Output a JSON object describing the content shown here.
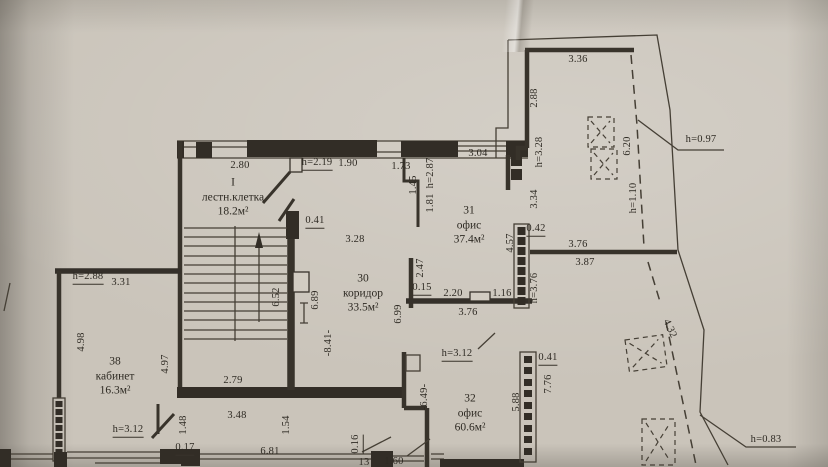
{
  "document": {
    "kind": "floor-plan photograph",
    "language": "ru"
  },
  "colors": {
    "paper": "#cac4ba",
    "ink": "#38332b"
  },
  "rooms": [
    {
      "number": "I",
      "name": "лестн.клетка",
      "area": "18.2м²",
      "x": 233,
      "y": 197
    },
    {
      "number": "30",
      "name": "коридор",
      "area": "33.5м²",
      "x": 363,
      "y": 293
    },
    {
      "number": "31",
      "name": "офис",
      "area": "37.4м²",
      "x": 469,
      "y": 225
    },
    {
      "number": "32",
      "name": "офис",
      "area": "60.6м²",
      "x": 470,
      "y": 413
    },
    {
      "number": "38",
      "name": "кабинет",
      "area": "16.3м²",
      "x": 115,
      "y": 376
    }
  ],
  "annotations": [
    {
      "t": "2.80",
      "x": 240,
      "y": 166
    },
    {
      "t": "h=2.19",
      "x": 317,
      "y": 164,
      "u": 1
    },
    {
      "t": "1.90",
      "x": 348,
      "y": 164
    },
    {
      "t": "1.73",
      "x": 401,
      "y": 167
    },
    {
      "t": "3.04",
      "x": 478,
      "y": 154
    },
    {
      "t": "1.45",
      "x": 414,
      "y": 185,
      "r": -90
    },
    {
      "t": "h=2.87",
      "x": 431,
      "y": 173,
      "r": -90
    },
    {
      "t": "1.81",
      "x": 431,
      "y": 203,
      "r": -90
    },
    {
      "t": "0.41",
      "x": 315,
      "y": 222,
      "u": 1
    },
    {
      "t": "3.28",
      "x": 355,
      "y": 240
    },
    {
      "t": "3.36",
      "x": 578,
      "y": 60
    },
    {
      "t": "2.88",
      "x": 535,
      "y": 98,
      "r": -90
    },
    {
      "t": "h=3.28",
      "x": 540,
      "y": 152,
      "r": -90
    },
    {
      "t": "6.20",
      "x": 628,
      "y": 146,
      "r": -90
    },
    {
      "t": "h=1.10",
      "x": 634,
      "y": 198,
      "r": -90
    },
    {
      "t": "h=0.97",
      "x": 701,
      "y": 140
    },
    {
      "t": "3.34",
      "x": 535,
      "y": 199,
      "r": -90
    },
    {
      "t": "0.42",
      "x": 536,
      "y": 230,
      "u": 1
    },
    {
      "t": "4.57",
      "x": 511,
      "y": 243,
      "r": -90
    },
    {
      "t": "3.76",
      "x": 578,
      "y": 245
    },
    {
      "t": "3.87",
      "x": 585,
      "y": 263
    },
    {
      "t": "h=3.76",
      "x": 535,
      "y": 288,
      "r": -90
    },
    {
      "t": "2.47",
      "x": 421,
      "y": 268,
      "r": -90
    },
    {
      "t": "0.15",
      "x": 422,
      "y": 289,
      "u": 1
    },
    {
      "t": "2.20",
      "x": 453,
      "y": 294
    },
    {
      "t": "1.16",
      "x": 502,
      "y": 294
    },
    {
      "t": "3.76",
      "x": 468,
      "y": 313
    },
    {
      "t": "6.99",
      "x": 399,
      "y": 314,
      "r": -90
    },
    {
      "t": "6.89",
      "x": 316,
      "y": 300,
      "r": -90
    },
    {
      "t": "6.52",
      "x": 277,
      "y": 297,
      "r": -90
    },
    {
      "t": "-8.41-",
      "x": 329,
      "y": 343,
      "r": -90
    },
    {
      "t": "h=2.88",
      "x": 88,
      "y": 278,
      "u": 1
    },
    {
      "t": "3.31",
      "x": 121,
      "y": 283
    },
    {
      "t": "4.98",
      "x": 82,
      "y": 342,
      "r": -90
    },
    {
      "t": "4.97",
      "x": 166,
      "y": 364,
      "r": -90
    },
    {
      "t": "2.79",
      "x": 233,
      "y": 381
    },
    {
      "t": "3.48",
      "x": 237,
      "y": 416
    },
    {
      "t": "1.48",
      "x": 184,
      "y": 425,
      "r": -90
    },
    {
      "t": "1.54",
      "x": 287,
      "y": 425,
      "r": -90
    },
    {
      "t": "h=3.12",
      "x": 128,
      "y": 431,
      "u": 1
    },
    {
      "t": "0.17",
      "x": 185,
      "y": 449,
      "u": 1
    },
    {
      "t": "6.81",
      "x": 270,
      "y": 452
    },
    {
      "t": "h=3.12",
      "x": 457,
      "y": 355,
      "u": 1
    },
    {
      "t": "-6.49-",
      "x": 425,
      "y": 397,
      "r": -90
    },
    {
      "t": "5.88",
      "x": 517,
      "y": 402,
      "r": -90
    },
    {
      "t": "7.76",
      "x": 549,
      "y": 384,
      "r": -90
    },
    {
      "t": "0.41",
      "x": 548,
      "y": 359,
      "u": 1
    },
    {
      "t": "0.16",
      "x": 357,
      "y": 444,
      "r": -90,
      "u": 1
    },
    {
      "t": "1.60",
      "x": 394,
      "y": 462
    },
    {
      "t": "13",
      "x": 364,
      "y": 463
    },
    {
      "t": "h=0.83",
      "x": 766,
      "y": 440
    },
    {
      "t": "4.32",
      "x": 669,
      "y": 329,
      "r": 65
    }
  ]
}
